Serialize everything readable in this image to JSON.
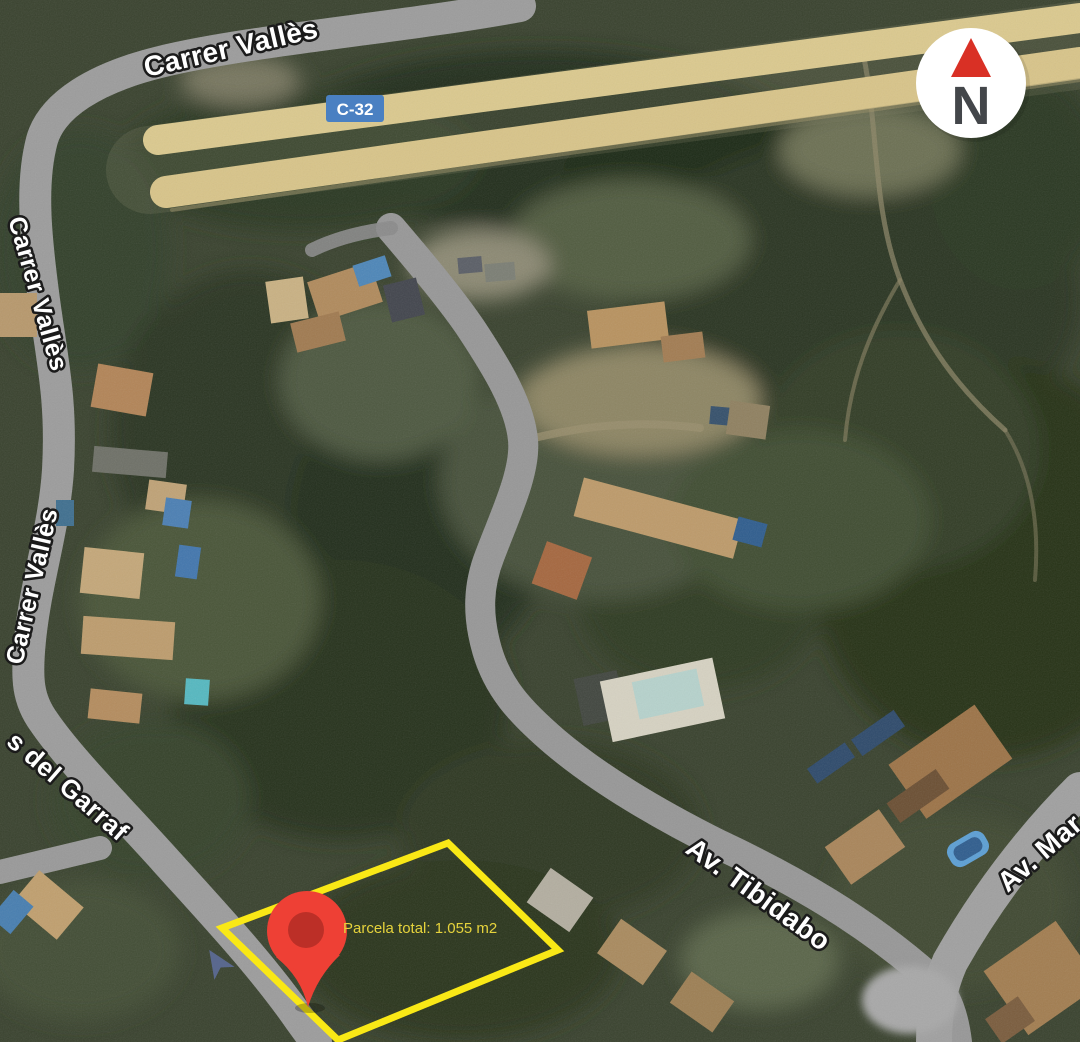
{
  "map": {
    "labels": {
      "carrer_valles_top": "Carrer Vallès",
      "carrer_valles_upper": "Carrer Vallès",
      "carrer_valles_lower": "Carrer Vallès",
      "garraf": "s del Garraf",
      "tibidabo": "Av. Tibidabo",
      "av_mar": "Av. Mar"
    },
    "route_badge": {
      "text": "C-32",
      "bg": "#4a80c2",
      "fg": "#ffffff"
    },
    "compass": {
      "letter": "N",
      "needle_color": "#d93025",
      "letter_color": "#43464a",
      "bg": "#ffffff"
    },
    "parcel": {
      "label": "Parcela total: 1.055 m2",
      "outline_color": "#f9e816",
      "label_color": "#e6d33c"
    },
    "pin": {
      "color": "#ee4035",
      "inner_color": "#bc2f27"
    },
    "arrow_color": "#5f6f9d"
  }
}
